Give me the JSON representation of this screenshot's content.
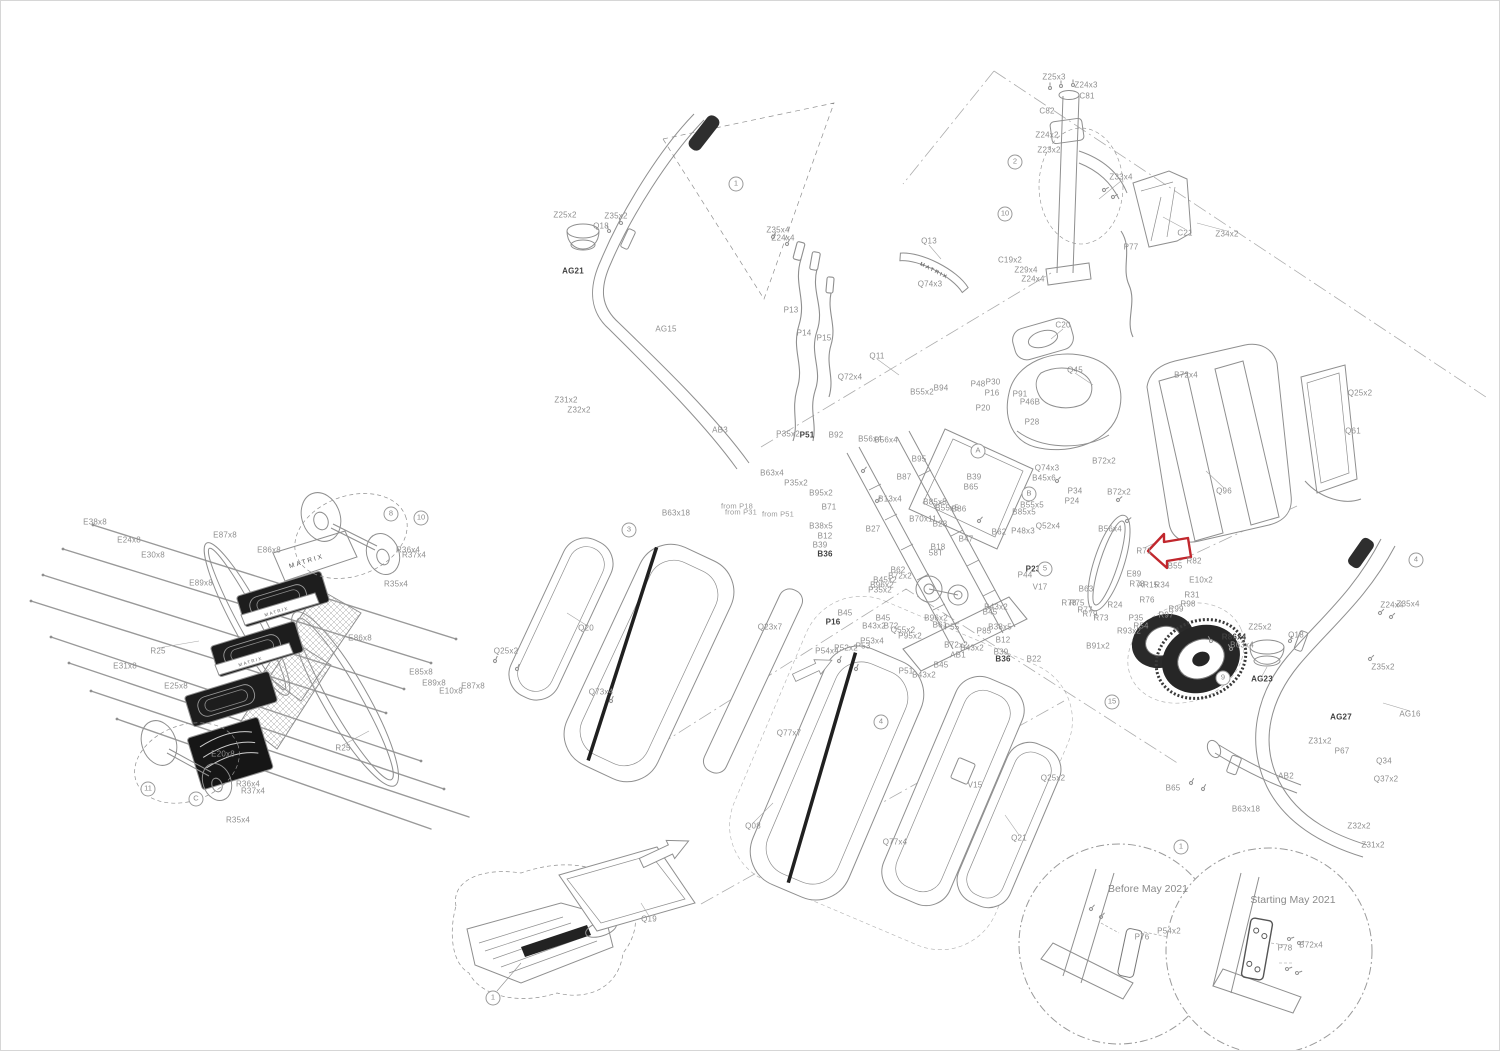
{
  "canvas": {
    "width": 1500,
    "height": 1051,
    "background": "#ffffff",
    "border_color": "#d6d6d6"
  },
  "colors": {
    "line": "#919191",
    "line_light": "#b5b5b5",
    "dark_part": "#1d1d1d",
    "label": "#8e8e8e",
    "label_bold": "#3f3f3f",
    "highlight_red": "#c1272d"
  },
  "brand": {
    "logo_text": "MATRIX"
  },
  "highlight_arrow": {
    "shape": "left-pointing-block-arrow",
    "x": 1167,
    "y": 550,
    "color": "#c1272d"
  },
  "insets": [
    {
      "label": "Before May 2021",
      "cx": 1118,
      "cy": 943,
      "r": 100,
      "title_x": 1147,
      "title_y": 888,
      "parts": [
        {
          "t": "P76",
          "x": 1141,
          "y": 936
        },
        {
          "t": "P54x2",
          "x": 1168,
          "y": 930
        }
      ]
    },
    {
      "label": "Starting May 2021",
      "cx": 1268,
      "cy": 950,
      "r": 103,
      "title_x": 1292,
      "title_y": 899,
      "parts": [
        {
          "t": "P78",
          "x": 1284,
          "y": 947
        },
        {
          "t": "B72x4",
          "x": 1310,
          "y": 944
        }
      ]
    }
  ],
  "notes": [
    {
      "t": "from P18",
      "x": 736,
      "y": 505
    },
    {
      "t": "from P31",
      "x": 740,
      "y": 511
    },
    {
      "t": "from P51",
      "x": 777,
      "y": 513
    }
  ],
  "circle_markers": [
    {
      "t": "1",
      "x": 735,
      "y": 183
    },
    {
      "t": "2",
      "x": 1014,
      "y": 161
    },
    {
      "t": "10",
      "x": 1004,
      "y": 213
    },
    {
      "t": "8",
      "x": 390,
      "y": 513
    },
    {
      "t": "10",
      "x": 420,
      "y": 517
    },
    {
      "t": "11",
      "x": 147,
      "y": 788
    },
    {
      "t": "C",
      "x": 195,
      "y": 798
    },
    {
      "t": "3",
      "x": 628,
      "y": 529
    },
    {
      "t": "4",
      "x": 880,
      "y": 721
    },
    {
      "t": "4",
      "x": 1415,
      "y": 559
    },
    {
      "t": "5",
      "x": 1044,
      "y": 568
    },
    {
      "t": "A",
      "x": 977,
      "y": 450
    },
    {
      "t": "B",
      "x": 1028,
      "y": 493
    },
    {
      "t": "15",
      "x": 1111,
      "y": 701
    },
    {
      "t": "9",
      "x": 1222,
      "y": 677
    },
    {
      "t": "1",
      "x": 492,
      "y": 997
    },
    {
      "t": "1",
      "x": 1180,
      "y": 846
    }
  ],
  "part_labels": [
    {
      "t": "Z25x3",
      "x": 1053,
      "y": 76
    },
    {
      "t": "Z24x3",
      "x": 1085,
      "y": 84
    },
    {
      "t": "C81",
      "x": 1086,
      "y": 95
    },
    {
      "t": "C82",
      "x": 1046,
      "y": 110
    },
    {
      "t": "Z24x2",
      "x": 1046,
      "y": 134
    },
    {
      "t": "Z23x2",
      "x": 1048,
      "y": 149
    },
    {
      "t": "Z33x4",
      "x": 1120,
      "y": 176
    },
    {
      "t": "C21",
      "x": 1184,
      "y": 232
    },
    {
      "t": "Z34x2",
      "x": 1226,
      "y": 233
    },
    {
      "t": "P77",
      "x": 1130,
      "y": 246
    },
    {
      "t": "C19x2",
      "x": 1009,
      "y": 259
    },
    {
      "t": "Z29x4",
      "x": 1025,
      "y": 269
    },
    {
      "t": "Z24x4",
      "x": 1032,
      "y": 278
    },
    {
      "t": "Q13",
      "x": 928,
      "y": 240
    },
    {
      "t": "Q74x3",
      "x": 929,
      "y": 283
    },
    {
      "t": "C20",
      "x": 1062,
      "y": 324
    },
    {
      "t": "Q45",
      "x": 1074,
      "y": 369
    },
    {
      "t": "B72x2",
      "x": 1103,
      "y": 460
    },
    {
      "t": "Q11",
      "x": 876,
      "y": 355
    },
    {
      "t": "B55x2",
      "x": 921,
      "y": 391
    },
    {
      "t": "B94",
      "x": 940,
      "y": 387
    },
    {
      "t": "P48",
      "x": 977,
      "y": 383
    },
    {
      "t": "P30",
      "x": 992,
      "y": 381
    },
    {
      "t": "P16",
      "x": 991,
      "y": 392
    },
    {
      "t": "P91",
      "x": 1019,
      "y": 393
    },
    {
      "t": "P46B",
      "x": 1029,
      "y": 401
    },
    {
      "t": "P20",
      "x": 982,
      "y": 407
    },
    {
      "t": "P28",
      "x": 1031,
      "y": 421
    },
    {
      "t": "Q74x3",
      "x": 1046,
      "y": 467
    },
    {
      "t": "B45x6",
      "x": 1043,
      "y": 477
    },
    {
      "t": "B56x4",
      "x": 869,
      "y": 438
    },
    {
      "t": "B95",
      "x": 918,
      "y": 458
    },
    {
      "t": "B87",
      "x": 903,
      "y": 476
    },
    {
      "t": "B39",
      "x": 973,
      "y": 476
    },
    {
      "t": "B65",
      "x": 970,
      "y": 486
    },
    {
      "t": "B85x5",
      "x": 934,
      "y": 501
    },
    {
      "t": "B55x5",
      "x": 946,
      "y": 507
    },
    {
      "t": "B86",
      "x": 958,
      "y": 508
    },
    {
      "t": "B13x4",
      "x": 889,
      "y": 498
    },
    {
      "t": "B27",
      "x": 872,
      "y": 528
    },
    {
      "t": "B70x11",
      "x": 922,
      "y": 518
    },
    {
      "t": "B23",
      "x": 939,
      "y": 523
    },
    {
      "t": "B18",
      "x": 937,
      "y": 546
    },
    {
      "t": "58T",
      "x": 935,
      "y": 552
    },
    {
      "t": "B47",
      "x": 965,
      "y": 538
    },
    {
      "t": "B62",
      "x": 998,
      "y": 531
    },
    {
      "t": "P48x3",
      "x": 1022,
      "y": 530
    },
    {
      "t": "Q52x4",
      "x": 1047,
      "y": 525
    },
    {
      "t": "B55x5",
      "x": 1031,
      "y": 504
    },
    {
      "t": "B85x5",
      "x": 1023,
      "y": 511
    },
    {
      "t": "B71",
      "x": 828,
      "y": 506
    },
    {
      "t": "B38x5",
      "x": 820,
      "y": 525
    },
    {
      "t": "B12",
      "x": 824,
      "y": 535
    },
    {
      "t": "B39",
      "x": 819,
      "y": 544
    },
    {
      "t": "B36",
      "x": 824,
      "y": 553,
      "b": 1
    },
    {
      "t": "B62",
      "x": 897,
      "y": 569
    },
    {
      "t": "B72x2",
      "x": 899,
      "y": 575
    },
    {
      "t": "B45x2",
      "x": 884,
      "y": 579
    },
    {
      "t": "B96x2",
      "x": 881,
      "y": 584
    },
    {
      "t": "P35x2",
      "x": 879,
      "y": 589
    },
    {
      "t": "B45",
      "x": 844,
      "y": 612
    },
    {
      "t": "P16",
      "x": 832,
      "y": 621,
      "b": 1
    },
    {
      "t": "B45",
      "x": 882,
      "y": 617
    },
    {
      "t": "B43x2",
      "x": 873,
      "y": 625
    },
    {
      "t": "B72",
      "x": 890,
      "y": 625
    },
    {
      "t": "Q55x2",
      "x": 902,
      "y": 629
    },
    {
      "t": "P95x2",
      "x": 909,
      "y": 635
    },
    {
      "t": "P53x4",
      "x": 871,
      "y": 640
    },
    {
      "t": "B61",
      "x": 939,
      "y": 624
    },
    {
      "t": "B96x2",
      "x": 935,
      "y": 617
    },
    {
      "t": "P55",
      "x": 951,
      "y": 626
    },
    {
      "t": "P85",
      "x": 983,
      "y": 630
    },
    {
      "t": "B43x2",
      "x": 995,
      "y": 606
    },
    {
      "t": "B45",
      "x": 989,
      "y": 611
    },
    {
      "t": "B72x2",
      "x": 955,
      "y": 644
    },
    {
      "t": "B43x2",
      "x": 971,
      "y": 647
    },
    {
      "t": "AB1",
      "x": 957,
      "y": 654
    },
    {
      "t": "B12",
      "x": 1002,
      "y": 639
    },
    {
      "t": "B39",
      "x": 1000,
      "y": 651
    },
    {
      "t": "B36",
      "x": 1002,
      "y": 658,
      "b": 1
    },
    {
      "t": "B22",
      "x": 1033,
      "y": 658
    },
    {
      "t": "B38x5",
      "x": 999,
      "y": 626
    },
    {
      "t": "V17",
      "x": 1039,
      "y": 586
    },
    {
      "t": "P44",
      "x": 1024,
      "y": 574
    },
    {
      "t": "P23",
      "x": 1032,
      "y": 568,
      "b": 1
    },
    {
      "t": "P34",
      "x": 1074,
      "y": 490
    },
    {
      "t": "P24",
      "x": 1071,
      "y": 500
    },
    {
      "t": "B72x2",
      "x": 1118,
      "y": 491
    },
    {
      "t": "B56x4",
      "x": 1109,
      "y": 528
    },
    {
      "t": "Q96",
      "x": 1223,
      "y": 490
    },
    {
      "t": "B72x4",
      "x": 1185,
      "y": 374
    },
    {
      "t": "Q25x2",
      "x": 1359,
      "y": 392
    },
    {
      "t": "Q61",
      "x": 1352,
      "y": 430
    },
    {
      "t": "R71",
      "x": 1143,
      "y": 550
    },
    {
      "t": "B55",
      "x": 1174,
      "y": 565
    },
    {
      "t": "R82",
      "x": 1193,
      "y": 560
    },
    {
      "t": "E10x2",
      "x": 1200,
      "y": 579
    },
    {
      "t": "E89",
      "x": 1133,
      "y": 573
    },
    {
      "t": "R78",
      "x": 1136,
      "y": 583
    },
    {
      "t": "AR15",
      "x": 1147,
      "y": 584
    },
    {
      "t": "R34",
      "x": 1161,
      "y": 584
    },
    {
      "t": "R31",
      "x": 1191,
      "y": 594
    },
    {
      "t": "R98",
      "x": 1187,
      "y": 603
    },
    {
      "t": "R99",
      "x": 1175,
      "y": 608
    },
    {
      "t": "R76",
      "x": 1146,
      "y": 599
    },
    {
      "t": "R24",
      "x": 1114,
      "y": 604
    },
    {
      "t": "B63",
      "x": 1085,
      "y": 588
    },
    {
      "t": "R78",
      "x": 1068,
      "y": 602
    },
    {
      "t": "R75",
      "x": 1076,
      "y": 602
    },
    {
      "t": "R77",
      "x": 1084,
      "y": 609
    },
    {
      "t": "R79",
      "x": 1089,
      "y": 613
    },
    {
      "t": "R73",
      "x": 1100,
      "y": 617
    },
    {
      "t": "P35",
      "x": 1135,
      "y": 617
    },
    {
      "t": "R54",
      "x": 1140,
      "y": 625
    },
    {
      "t": "R97",
      "x": 1165,
      "y": 614
    },
    {
      "t": "R93x2",
      "x": 1128,
      "y": 630
    },
    {
      "t": "B91x2",
      "x": 1097,
      "y": 645
    },
    {
      "t": "R86x4",
      "x": 1233,
      "y": 636,
      "b": 1
    },
    {
      "t": "B63x4",
      "x": 1241,
      "y": 644
    },
    {
      "t": "Z25x2",
      "x": 1259,
      "y": 626
    },
    {
      "t": "Q18",
      "x": 1295,
      "y": 634
    },
    {
      "t": "AG23",
      "x": 1261,
      "y": 678,
      "b": 1
    },
    {
      "t": "Z24x4",
      "x": 1391,
      "y": 604
    },
    {
      "t": "Z35x4",
      "x": 1407,
      "y": 603
    },
    {
      "t": "Z35x2",
      "x": 1382,
      "y": 666
    },
    {
      "t": "AG27",
      "x": 1340,
      "y": 716,
      "b": 1
    },
    {
      "t": "AG16",
      "x": 1409,
      "y": 713
    },
    {
      "t": "P67",
      "x": 1341,
      "y": 750
    },
    {
      "t": "Q34",
      "x": 1383,
      "y": 760
    },
    {
      "t": "Q37x2",
      "x": 1385,
      "y": 778
    },
    {
      "t": "Z31x2",
      "x": 1319,
      "y": 740
    },
    {
      "t": "AB2",
      "x": 1285,
      "y": 775
    },
    {
      "t": "Z32x2",
      "x": 1358,
      "y": 825
    },
    {
      "t": "Z31x2",
      "x": 1372,
      "y": 844
    },
    {
      "t": "B65",
      "x": 1172,
      "y": 787
    },
    {
      "t": "B63x18",
      "x": 1245,
      "y": 808
    },
    {
      "t": "Z25x2",
      "x": 564,
      "y": 214
    },
    {
      "t": "Z35x2",
      "x": 615,
      "y": 215
    },
    {
      "t": "Q18",
      "x": 600,
      "y": 225
    },
    {
      "t": "AG21",
      "x": 572,
      "y": 270,
      "b": 1
    },
    {
      "t": "Z35x4",
      "x": 777,
      "y": 229
    },
    {
      "t": "Z24x4",
      "x": 782,
      "y": 237
    },
    {
      "t": "AG15",
      "x": 665,
      "y": 328
    },
    {
      "t": "P13",
      "x": 790,
      "y": 309
    },
    {
      "t": "P14",
      "x": 803,
      "y": 332
    },
    {
      "t": "P15",
      "x": 823,
      "y": 337
    },
    {
      "t": "Q72x4",
      "x": 849,
      "y": 376
    },
    {
      "t": "Z31x2",
      "x": 565,
      "y": 399
    },
    {
      "t": "Z32x2",
      "x": 578,
      "y": 409
    },
    {
      "t": "AB3",
      "x": 719,
      "y": 429
    },
    {
      "t": "P35x2",
      "x": 787,
      "y": 433
    },
    {
      "t": "P51",
      "x": 806,
      "y": 434,
      "b": 1
    },
    {
      "t": "B92",
      "x": 835,
      "y": 434
    },
    {
      "t": "B56x4",
      "x": 885,
      "y": 439
    },
    {
      "t": "B63x4",
      "x": 771,
      "y": 472
    },
    {
      "t": "P35x2",
      "x": 795,
      "y": 482
    },
    {
      "t": "B95x2",
      "x": 820,
      "y": 492
    },
    {
      "t": "B63x18",
      "x": 675,
      "y": 512
    },
    {
      "t": "Q20",
      "x": 585,
      "y": 627
    },
    {
      "t": "Q25x2",
      "x": 505,
      "y": 650
    },
    {
      "t": "Q73x4",
      "x": 600,
      "y": 691
    },
    {
      "t": "Q23x7",
      "x": 769,
      "y": 626
    },
    {
      "t": "Q77x7",
      "x": 788,
      "y": 732
    },
    {
      "t": "Q08",
      "x": 752,
      "y": 825
    },
    {
      "t": "Q77x4",
      "x": 894,
      "y": 841
    },
    {
      "t": "V15",
      "x": 974,
      "y": 784
    },
    {
      "t": "Q21",
      "x": 1018,
      "y": 837
    },
    {
      "t": "Q25x2",
      "x": 1052,
      "y": 777
    },
    {
      "t": "B45",
      "x": 940,
      "y": 664
    },
    {
      "t": "B43x2",
      "x": 923,
      "y": 674
    },
    {
      "t": "P51",
      "x": 905,
      "y": 670
    },
    {
      "t": "P52x2",
      "x": 845,
      "y": 647
    },
    {
      "t": "P54x4",
      "x": 826,
      "y": 650
    },
    {
      "t": "P53",
      "x": 862,
      "y": 645
    },
    {
      "t": "Q19",
      "x": 648,
      "y": 918
    },
    {
      "t": "E87x8",
      "x": 224,
      "y": 534
    },
    {
      "t": "E86x8",
      "x": 268,
      "y": 549
    },
    {
      "t": "E89x8",
      "x": 200,
      "y": 582
    },
    {
      "t": "E38x8",
      "x": 94,
      "y": 521
    },
    {
      "t": "E24x8",
      "x": 128,
      "y": 539
    },
    {
      "t": "E30x8",
      "x": 152,
      "y": 554
    },
    {
      "t": "E31x8",
      "x": 124,
      "y": 665
    },
    {
      "t": "E25x8",
      "x": 175,
      "y": 685
    },
    {
      "t": "R25",
      "x": 157,
      "y": 650
    },
    {
      "t": "R25",
      "x": 342,
      "y": 747
    },
    {
      "t": "E20x8",
      "x": 222,
      "y": 753
    },
    {
      "t": "E86x8",
      "x": 359,
      "y": 637
    },
    {
      "t": "E85x8",
      "x": 420,
      "y": 671
    },
    {
      "t": "E89x8",
      "x": 433,
      "y": 682
    },
    {
      "t": "E10x8",
      "x": 450,
      "y": 690
    },
    {
      "t": "E87x8",
      "x": 472,
      "y": 685
    },
    {
      "t": "R36x4",
      "x": 407,
      "y": 549
    },
    {
      "t": "R37x4",
      "x": 413,
      "y": 554
    },
    {
      "t": "R35x4",
      "x": 395,
      "y": 583
    },
    {
      "t": "R36x4",
      "x": 247,
      "y": 783
    },
    {
      "t": "R37x4",
      "x": 252,
      "y": 790
    },
    {
      "t": "R35x4",
      "x": 237,
      "y": 819
    }
  ]
}
